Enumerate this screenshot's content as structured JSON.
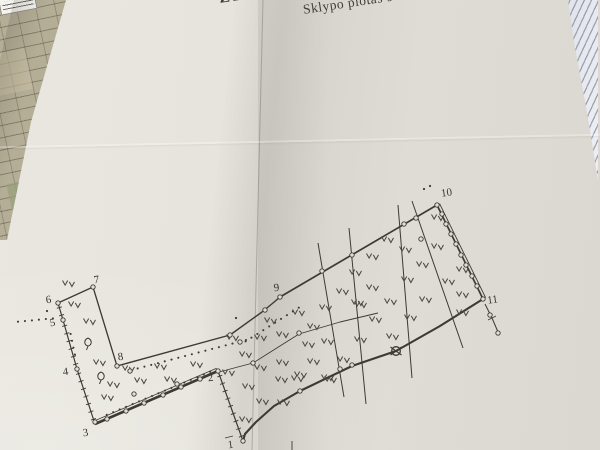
{
  "heading": {
    "title_fragment": "ŽEMĖS SK",
    "subtitle_fragment": "Sklypo plotas 90"
  },
  "plan": {
    "ink": "#3c3a33",
    "paper": "#e0ded6",
    "label_color": "#34332d",
    "vertex_labels": [
      {
        "n": "1",
        "x": 231,
        "y": 448
      },
      {
        "n": "2",
        "x": 211,
        "y": 381
      },
      {
        "n": "3",
        "x": 86,
        "y": 436
      },
      {
        "n": "4",
        "x": 66,
        "y": 375
      },
      {
        "n": "5",
        "x": 53,
        "y": 326
      },
      {
        "n": "6",
        "x": 49,
        "y": 303
      },
      {
        "n": "7",
        "x": 97,
        "y": 283
      },
      {
        "n": "8",
        "x": 121,
        "y": 360
      },
      {
        "n": "9",
        "x": 277,
        "y": 291
      },
      {
        "n": "10",
        "x": 447,
        "y": 196
      },
      {
        "n": "11",
        "x": 493,
        "y": 303
      }
    ],
    "edges": [
      {
        "name": "1-2",
        "type": "ticks",
        "w": 1.2,
        "pts": [
          [
            243,
            441
          ],
          [
            218,
            371
          ]
        ]
      },
      {
        "name": "2-3",
        "type": "plain",
        "w": 2.6,
        "pts": [
          [
            218,
            371
          ],
          [
            95,
            424
          ]
        ]
      },
      {
        "name": "2-3b",
        "type": "plain",
        "w": 0.8,
        "pts": [
          [
            216.6,
            368.2
          ],
          [
            93.6,
            421.2
          ]
        ]
      },
      {
        "name": "3-4",
        "type": "ticks",
        "w": 1.2,
        "pts": [
          [
            95,
            424
          ],
          [
            77,
            369
          ]
        ]
      },
      {
        "name": "4-6",
        "type": "ticks",
        "w": 1.2,
        "pts": [
          [
            77,
            369
          ],
          [
            63,
            320
          ],
          [
            58,
            303
          ]
        ]
      },
      {
        "name": "6-7",
        "type": "plain",
        "w": 1.3,
        "pts": [
          [
            58,
            303
          ],
          [
            93,
            287
          ]
        ]
      },
      {
        "name": "7-8",
        "type": "plain",
        "w": 1.3,
        "pts": [
          [
            93,
            287
          ],
          [
            117,
            366
          ]
        ]
      },
      {
        "name": "8-9",
        "type": "plain",
        "w": 1.4,
        "pts": [
          [
            117,
            366
          ],
          [
            230,
            335
          ],
          [
            262,
            312
          ],
          [
            273,
            303
          ],
          [
            280,
            297
          ]
        ]
      },
      {
        "name": "9-10",
        "type": "plain",
        "w": 1.7,
        "pts": [
          [
            280,
            297
          ],
          [
            437,
            205
          ]
        ]
      },
      {
        "name": "10-11",
        "type": "plain",
        "w": 1.7,
        "pts": [
          [
            437,
            205
          ],
          [
            483,
            299
          ]
        ]
      },
      {
        "name": "10-11b",
        "type": "plain",
        "w": 0.9,
        "pts": [
          [
            439.6,
            203.7
          ],
          [
            485.6,
            297.7
          ]
        ]
      },
      {
        "name": "11-1",
        "type": "plain",
        "w": 2.1,
        "pts": [
          [
            483,
            299
          ],
          [
            440,
            326
          ],
          [
            396,
            351
          ],
          [
            352,
            366
          ],
          [
            300,
            391
          ],
          [
            274,
            406
          ],
          [
            256,
            422
          ],
          [
            245,
            434
          ],
          [
            243,
            441
          ]
        ]
      },
      {
        "name": "mid",
        "type": "plain",
        "w": 0.9,
        "pts": [
          [
            219,
            372
          ],
          [
            253,
            363
          ],
          [
            299,
            334
          ],
          [
            340,
            322
          ],
          [
            378,
            313
          ]
        ]
      },
      {
        "name": "i1",
        "type": "plain",
        "w": 1.0,
        "pts": [
          [
            318,
            243
          ],
          [
            344,
            397
          ]
        ]
      },
      {
        "name": "i2",
        "type": "plain",
        "w": 1.0,
        "pts": [
          [
            349,
            228
          ],
          [
            366,
            404
          ]
        ]
      },
      {
        "name": "i3",
        "type": "plain",
        "w": 1.0,
        "pts": [
          [
            398,
            205
          ],
          [
            412,
            378
          ]
        ]
      },
      {
        "name": "i4",
        "type": "plain",
        "w": 1.0,
        "pts": [
          [
            412,
            201
          ],
          [
            463,
            348
          ]
        ]
      },
      {
        "name": "ref-11",
        "type": "plain",
        "w": 1.0,
        "pts": [
          [
            485,
            304
          ],
          [
            492,
            318
          ],
          [
            498,
            332
          ]
        ]
      },
      {
        "name": "ref-11t",
        "type": "plain",
        "w": 0.9,
        "pts": [
          [
            488,
            320
          ],
          [
            496,
            316
          ]
        ]
      },
      {
        "name": "ref-1a",
        "type": "plain",
        "w": 0.9,
        "pts": [
          [
            225,
            438
          ],
          [
            233,
            436
          ]
        ]
      },
      {
        "name": "ref-1b",
        "type": "plain",
        "w": 0.9,
        "pts": [
          [
            292,
            441
          ],
          [
            292,
            450
          ]
        ]
      }
    ],
    "markers": {
      "circles": [
        [
          95,
          422
        ],
        [
          77,
          369
        ],
        [
          63,
          320
        ],
        [
          58,
          303
        ],
        [
          93,
          287
        ],
        [
          117,
          366
        ],
        [
          218,
          371
        ],
        [
          243,
          441
        ],
        [
          280,
          297
        ],
        [
          437,
          205
        ],
        [
          483,
          299
        ],
        [
          230,
          335
        ],
        [
          265,
          310
        ],
        [
          300,
          391
        ],
        [
          107,
          419
        ],
        [
          126,
          411
        ],
        [
          144,
          403
        ],
        [
          163,
          395
        ],
        [
          181,
          387
        ],
        [
          200,
          379
        ],
        [
          442,
          214
        ],
        [
          446,
          224
        ],
        [
          451,
          234
        ],
        [
          456,
          244
        ],
        [
          461,
          255
        ],
        [
          466,
          265
        ],
        [
          472,
          276
        ],
        [
          477,
          286
        ],
        [
          322,
          271
        ],
        [
          352,
          255
        ],
        [
          404,
          224
        ],
        [
          416,
          218
        ],
        [
          340,
          369
        ],
        [
          352,
          365
        ],
        [
          421,
          239
        ],
        [
          253,
          363
        ],
        [
          299,
          333
        ],
        [
          134,
          394
        ],
        [
          177,
          384
        ],
        [
          240,
          342
        ],
        [
          130,
          371
        ],
        [
          490,
          315
        ],
        [
          498,
          333
        ]
      ],
      "benchmark": [
        396,
        351
      ],
      "dots": [
        [
          424,
          189
        ],
        [
          430,
          186
        ],
        [
          47,
          311
        ],
        [
          236,
          318
        ]
      ]
    },
    "dotted_paths": [
      [
        [
          15,
          322
        ],
        [
          57,
          318
        ]
      ],
      [
        [
          104,
          416
        ],
        [
          212,
          371
        ]
      ],
      [
        [
          128,
          371
        ],
        [
          250,
          339
        ]
      ],
      [
        [
          243,
          343
        ],
        [
          303,
          305
        ]
      ],
      [
        [
          70,
          331
        ],
        [
          76,
          360
        ]
      ]
    ],
    "grass": [
      [
        68,
        284
      ],
      [
        74,
        305
      ],
      [
        89,
        322
      ],
      [
        99,
        363
      ],
      [
        128,
        369
      ],
      [
        160,
        367
      ],
      [
        196,
        365
      ],
      [
        113,
        385
      ],
      [
        140,
        381
      ],
      [
        170,
        380
      ],
      [
        107,
        398
      ],
      [
        228,
        373
      ],
      [
        248,
        387
      ],
      [
        262,
        402
      ],
      [
        245,
        420
      ],
      [
        281,
        380
      ],
      [
        297,
        379
      ],
      [
        283,
        403
      ],
      [
        232,
        338
      ],
      [
        260,
        338
      ],
      [
        245,
        355
      ],
      [
        260,
        368
      ],
      [
        282,
        363
      ],
      [
        300,
        375
      ],
      [
        330,
        380
      ],
      [
        270,
        321
      ],
      [
        282,
        335
      ],
      [
        298,
        313
      ],
      [
        313,
        327
      ],
      [
        308,
        345
      ],
      [
        313,
        362
      ],
      [
        327,
        342
      ],
      [
        327,
        378
      ],
      [
        343,
        360
      ],
      [
        360,
        340
      ],
      [
        375,
        320
      ],
      [
        392,
        337
      ],
      [
        325,
        308
      ],
      [
        342,
        292
      ],
      [
        360,
        305
      ],
      [
        390,
        302
      ],
      [
        410,
        318
      ],
      [
        425,
        300
      ],
      [
        448,
        282
      ],
      [
        462,
        313
      ],
      [
        462,
        295
      ],
      [
        355,
        273
      ],
      [
        372,
        288
      ],
      [
        357,
        303
      ],
      [
        387,
        240
      ],
      [
        372,
        257
      ],
      [
        405,
        250
      ],
      [
        422,
        265
      ],
      [
        407,
        280
      ],
      [
        437,
        218
      ],
      [
        437,
        247
      ],
      [
        462,
        270
      ]
    ],
    "trees": [
      [
        88,
        343
      ],
      [
        101,
        377
      ]
    ]
  }
}
